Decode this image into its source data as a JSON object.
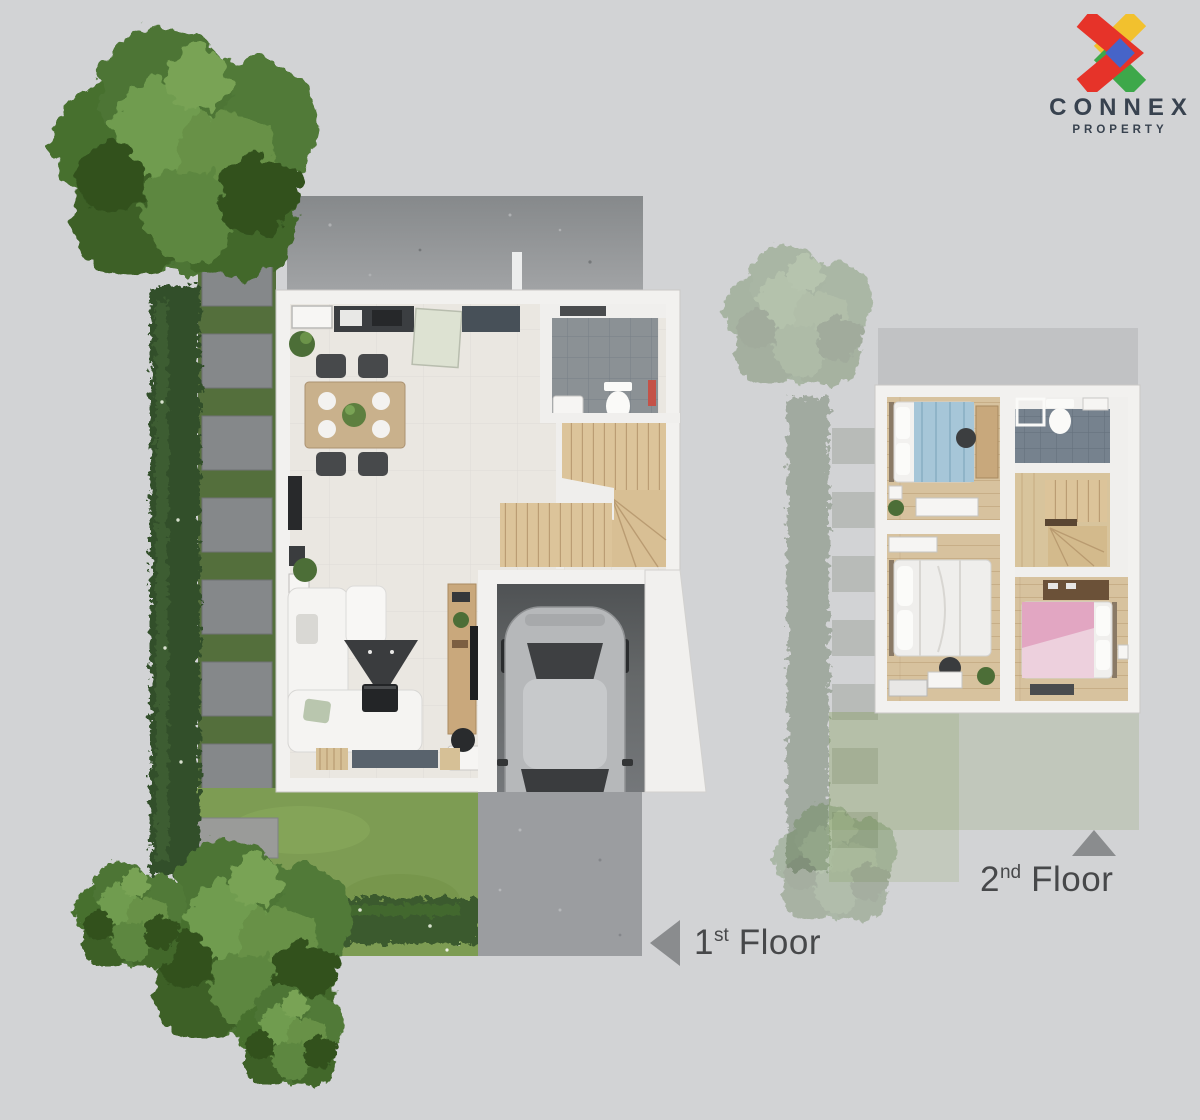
{
  "page": {
    "background": "#d2d3d5"
  },
  "logo": {
    "brand": "CONNEX",
    "subtitle": "PROPERTY",
    "text_color": "#38424f",
    "x_colors": {
      "red": "#e63329",
      "yellow": "#f2c12e",
      "green": "#3da84a",
      "blue": "#4664c8"
    }
  },
  "labels": {
    "first_floor": {
      "number": "1",
      "suffix": "st",
      "word": "Floor",
      "arrow_direction": "left"
    },
    "second_floor": {
      "number": "2",
      "suffix": "nd",
      "word": "Floor",
      "arrow_direction": "up"
    },
    "text_color": "#47484a",
    "arrow_color": "#8a8c8e"
  },
  "palette": {
    "background": "#d2d3d5",
    "wall_white": "#f2f1ef",
    "interior_floor": "#eae7e1",
    "wood_stairs": "#dcc49a",
    "bedroom_wood": "#d7c29e",
    "bath_tile_1f": "#8b9195",
    "bath_tile_2f": "#76828e",
    "garage_floor": "#5e6163",
    "driveway": "#9b9da0",
    "rear_patio": "#8a8d8f",
    "lawn": "#7d9c53",
    "grass_strip": "#546f3c",
    "hedge": "#33502a",
    "tree": "#4d7536",
    "stepping_stone": "#85888a",
    "car_body": "#b6b8ba",
    "blue_bed": "#a6c6d8",
    "pink_bed": "#e2a6c2",
    "ghost_opacity": 0.3
  }
}
